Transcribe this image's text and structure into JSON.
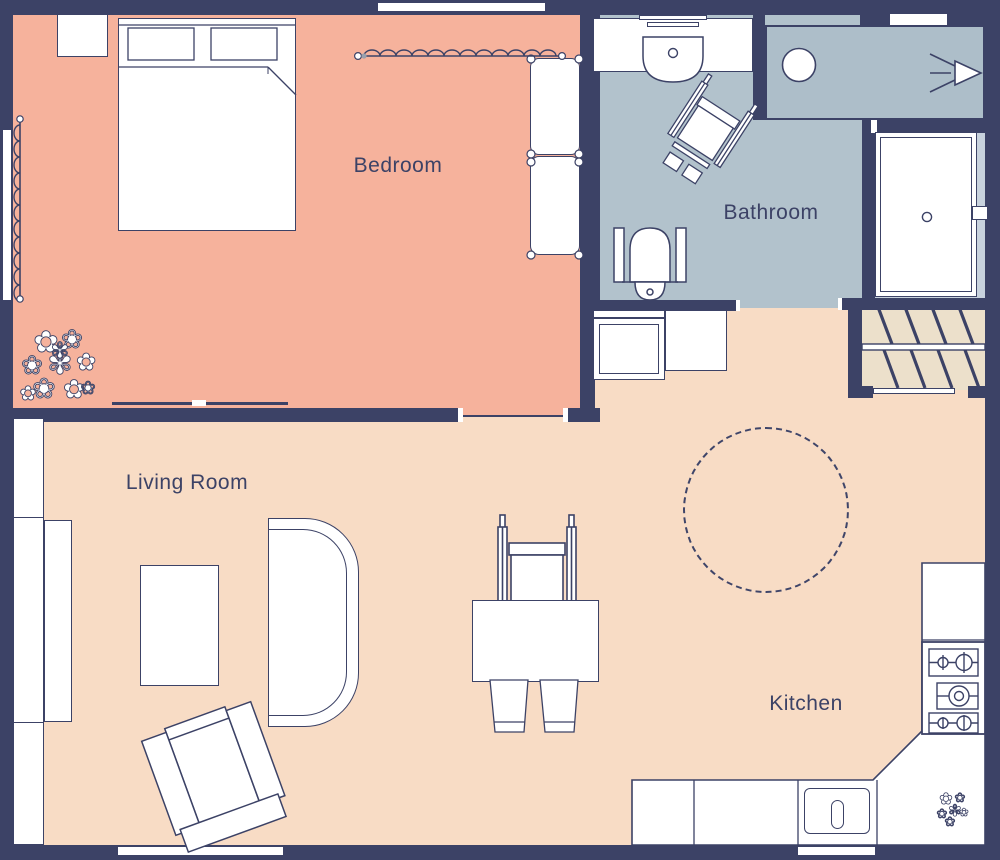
{
  "rooms": [
    {
      "id": "bedroom",
      "label": "Bedroom",
      "floor_color": "#f6b29c"
    },
    {
      "id": "bathroom",
      "label": "Bathroom",
      "floor_color": "#b2c2cc"
    },
    {
      "id": "living_room",
      "label": "Living Room",
      "floor_color": "#f8dcc5"
    },
    {
      "id": "kitchen",
      "label": "Kitchen",
      "floor_color": "#f8dcc5"
    }
  ],
  "colors": {
    "wall": "#3c4266",
    "bedroom_floor": "#f6b29c",
    "bathroom_floor": "#b2c2cc",
    "shower_floor": "#adbec9",
    "living_kitchen_floor": "#f8dcc5",
    "entry_vestibule_floor": "#c8d2dd",
    "stairs_floor": "#ece0cb",
    "furniture_fill": "#ffffff",
    "outline": "#3c4266",
    "label_text": "#3c4266"
  },
  "symbols": {
    "bedroom": [
      "double-bed",
      "pillows",
      "nightstand",
      "window-curtain-top",
      "window-curtain-left",
      "bench-seat-upper",
      "bench-seat-lower",
      "plant",
      "sliding-door"
    ],
    "bathroom": [
      "sink-counter",
      "wash-basin",
      "wheelchair",
      "toilet-with-grab-bars",
      "walk-in-shower",
      "shower-drain",
      "shower-spray"
    ],
    "entry": [
      "entry-door",
      "door-handle",
      "stairs",
      "threshold",
      "washing-machine",
      "cabinet"
    ],
    "living_room": [
      "wall-shelf",
      "sideboard",
      "coffee-table",
      "sofa",
      "armchair",
      "window-bottom"
    ],
    "kitchen": [
      "dining-table",
      "dining-chairs",
      "wheelchair",
      "turning-radius-circle",
      "l-shaped-counter",
      "kitchen-sink",
      "stove-cooktop",
      "plant",
      "window-behind-sink"
    ]
  }
}
